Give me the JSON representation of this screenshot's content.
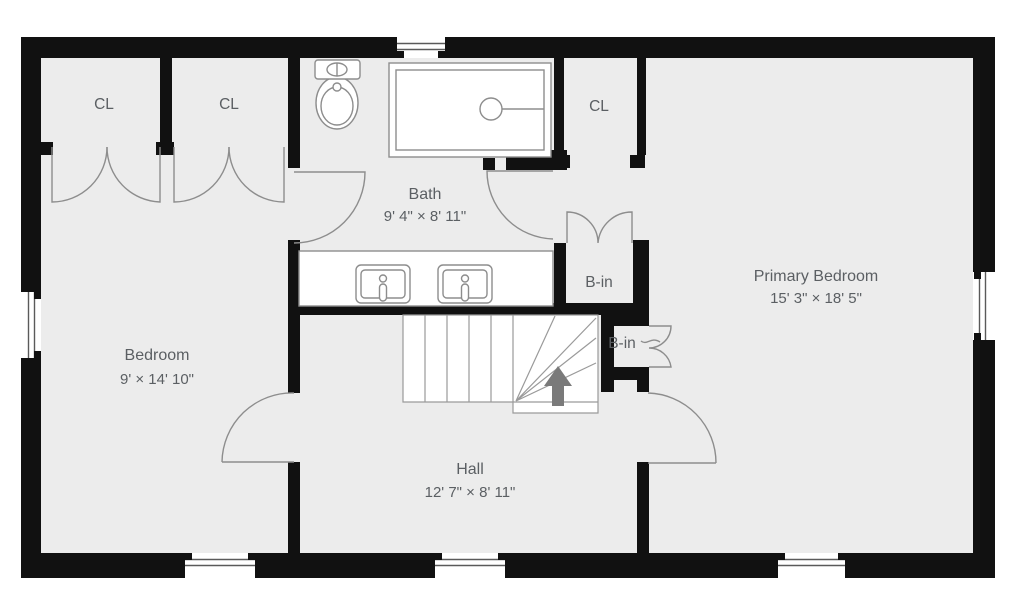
{
  "floorplan": {
    "rooms": {
      "bath": {
        "name": "Bath",
        "dims": "9' 4\" × 8' 11\""
      },
      "primary": {
        "name": "Primary Bedroom",
        "dims": "15' 3\" × 18' 5\""
      },
      "bedroom": {
        "name": "Bedroom",
        "dims": "9' × 14' 10\""
      },
      "hall": {
        "name": "Hall",
        "dims": "12' 7\" × 8' 11\""
      }
    },
    "closets": [
      "CL",
      "CL",
      "CL"
    ],
    "builtins": [
      "B-in",
      "B-in"
    ],
    "colors": {
      "wall": "#111111",
      "floor": "#ececec",
      "line": "#8d8d8d",
      "stairline": "#9a9a9a",
      "text": "#5b5f63",
      "arrow": "#7a7a7a"
    }
  }
}
